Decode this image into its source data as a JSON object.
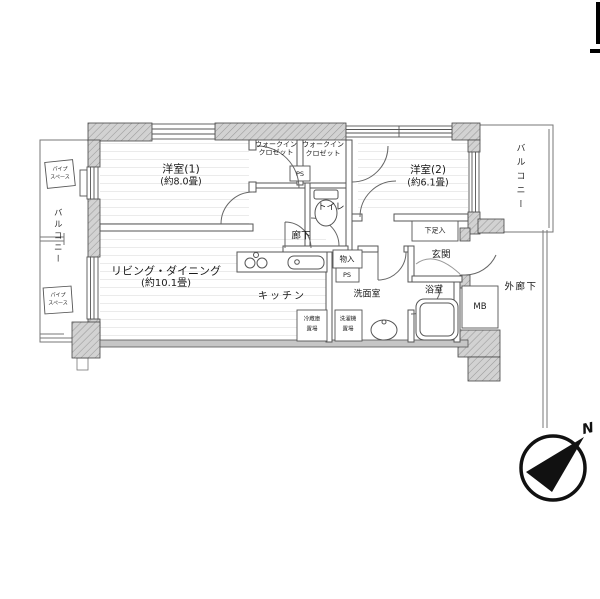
{
  "rooms": {
    "bedroom1": {
      "name": "洋室(1)",
      "size": "(約8.0畳)"
    },
    "bedroom2": {
      "name": "洋室(2)",
      "size": "(約6.1畳)"
    },
    "living_dining": {
      "name": "リビング・ダイニング",
      "size": "(約10.1畳)"
    },
    "kitchen": {
      "name": "キッチン"
    },
    "toilet": {
      "name": "トイレ"
    },
    "hallway": {
      "name": "廊下"
    },
    "washroom": {
      "name": "洗面室"
    },
    "bathroom": {
      "name": "浴室"
    },
    "entrance": {
      "name": "玄関"
    },
    "outer_corridor": {
      "name": "外廊下"
    },
    "balcony_left": {
      "name": "バルコニー"
    },
    "balcony_right": {
      "name": "バルコニー"
    },
    "wic1": {
      "line1": "ウォークイン",
      "line2": "クロゼット"
    },
    "wic2": {
      "line1": "ウォークイン",
      "line2": "クロゼット"
    }
  },
  "fixtures": {
    "shoe_cabinet": "下足入",
    "storage": "物入",
    "pipe_space_1": "PS",
    "pipe_space_2": "PS",
    "meter_box": "MB",
    "fridge_space": {
      "line1": "冷蔵庫",
      "line2": "置場"
    },
    "washer_space": {
      "line1": "洗濯機",
      "line2": "置場"
    },
    "balcony_pipe_1": {
      "line1": "パイプ",
      "line2": "スペース"
    },
    "balcony_pipe_2": {
      "line1": "パイプ",
      "line2": "スペース"
    }
  },
  "compass": {
    "north": "N"
  },
  "colors": {
    "background": "#ffffff",
    "wall_fill": "#d2d2d2",
    "wall_hatch": "#9a9a9a",
    "wall_line": "#444444",
    "thin_line": "#666666",
    "text": "#1a1a1a",
    "compass": "#111111"
  }
}
